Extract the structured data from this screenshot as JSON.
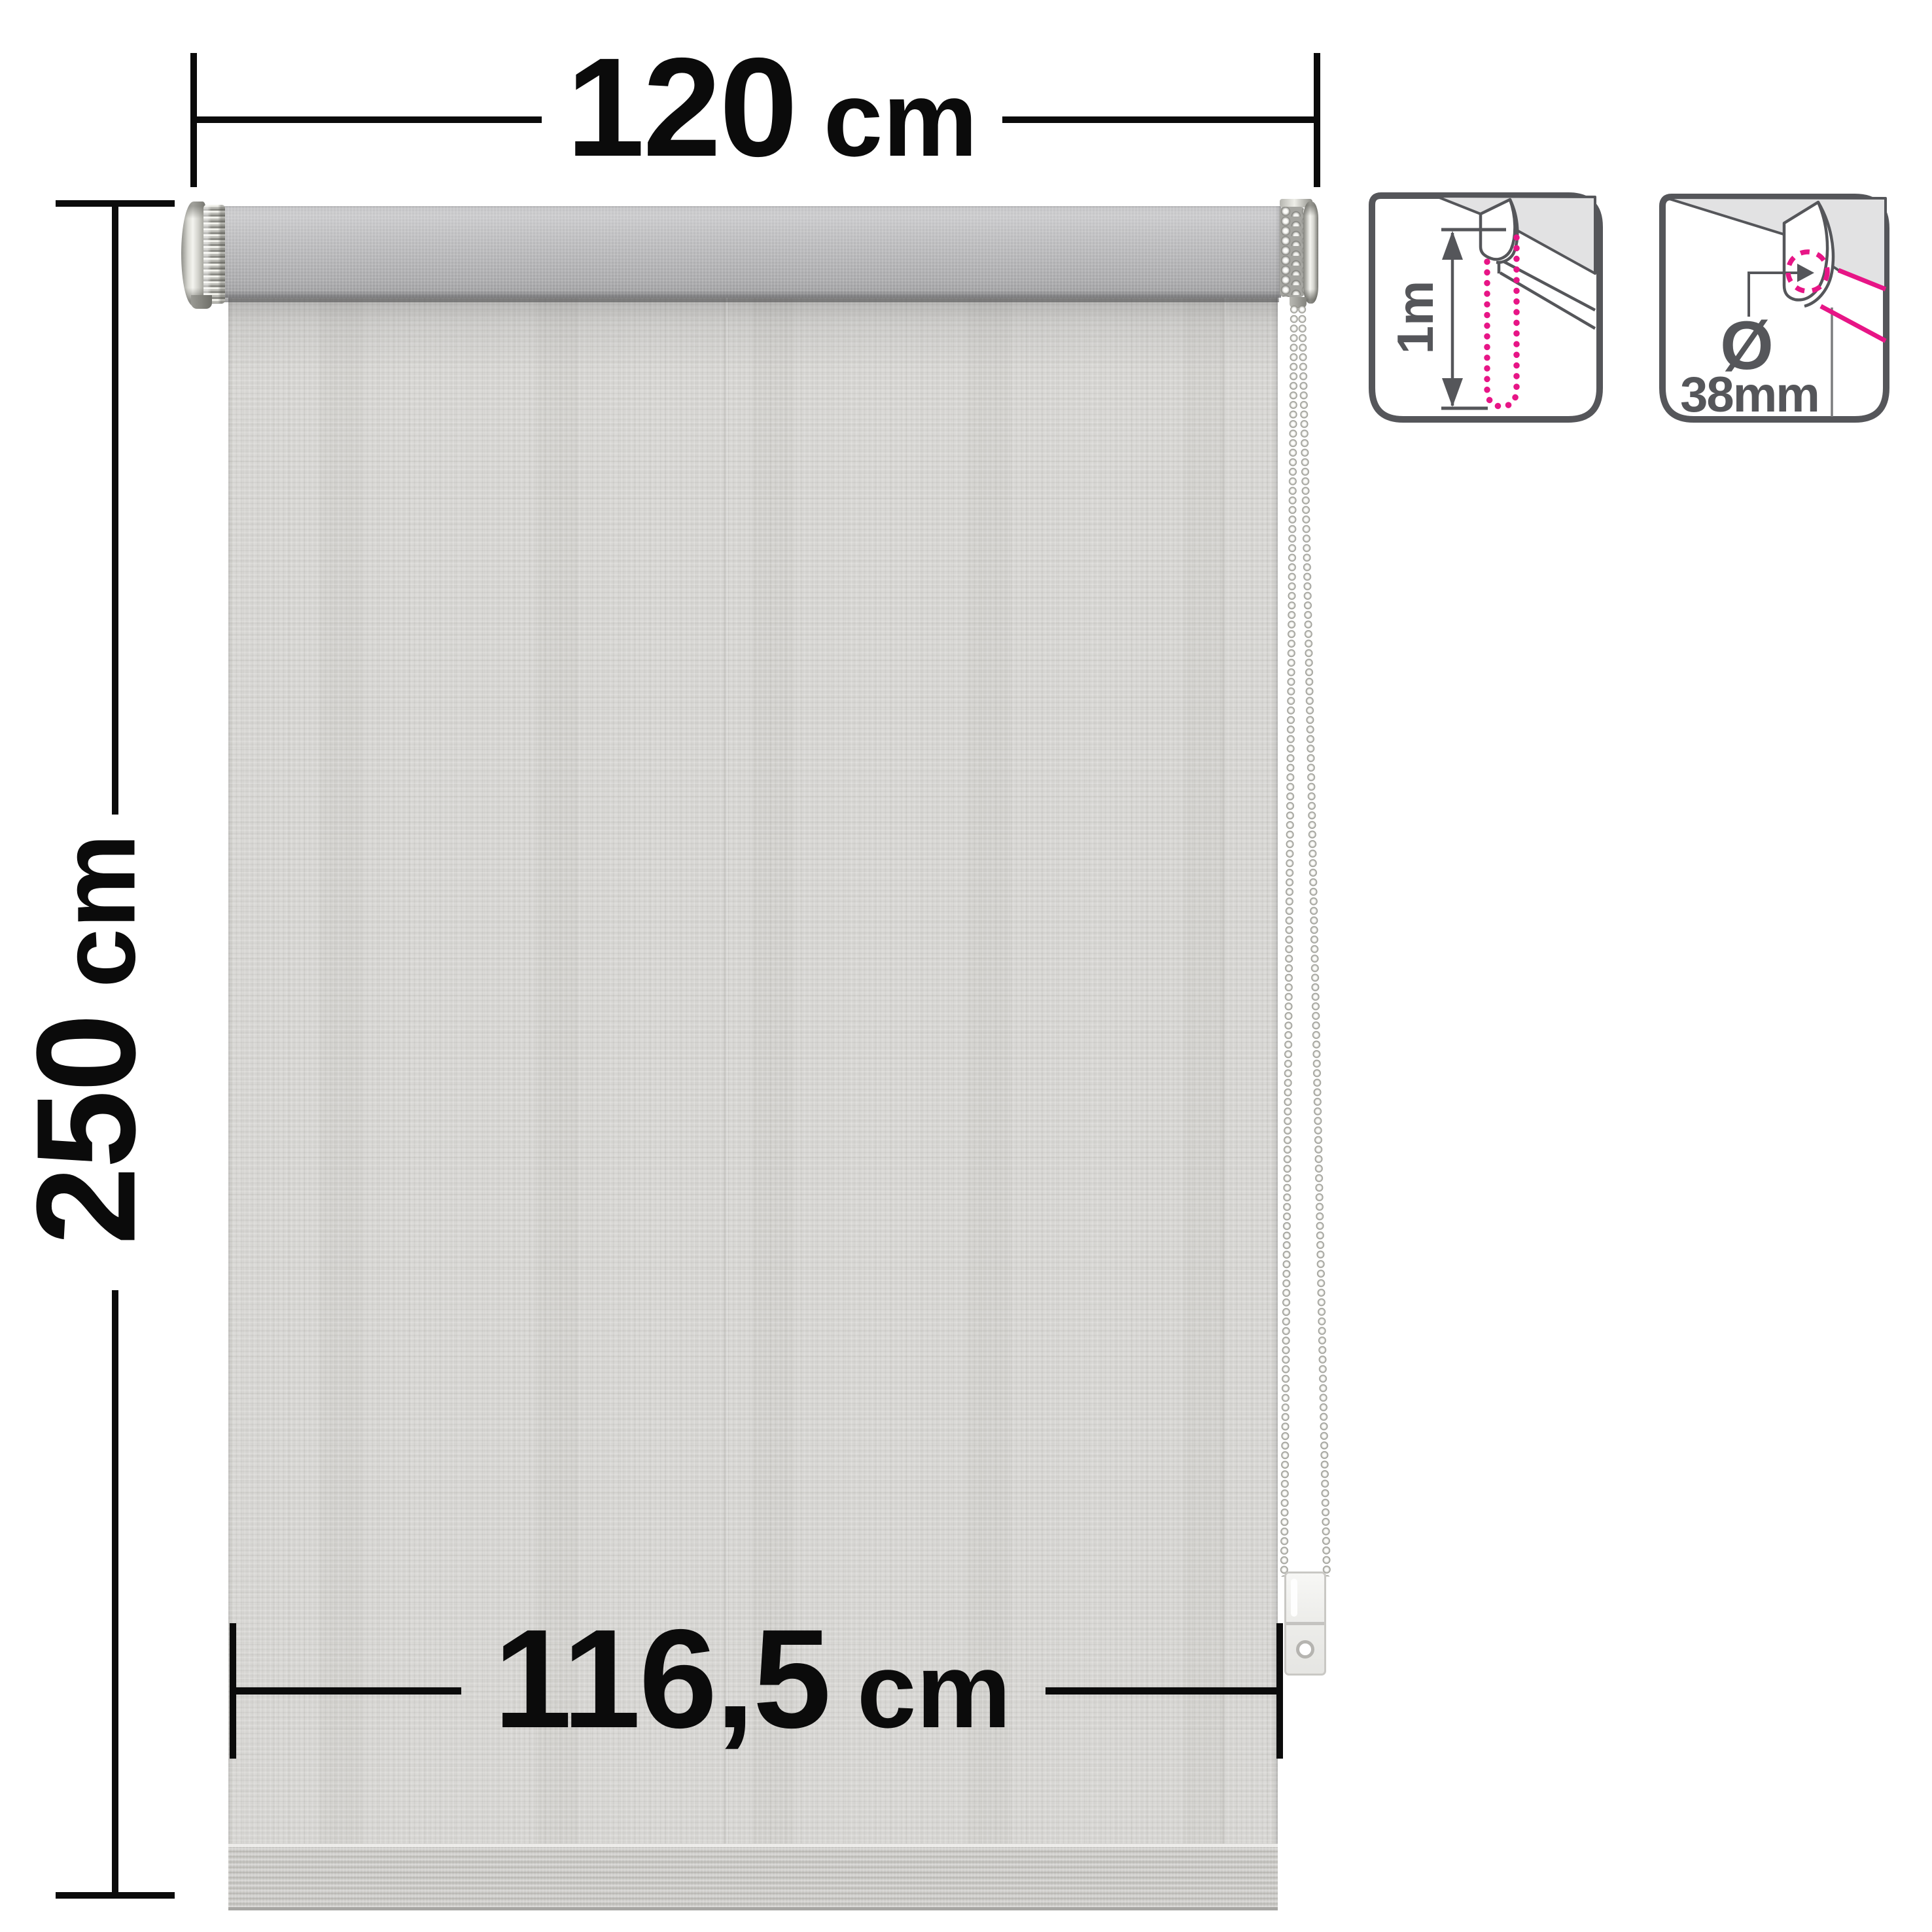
{
  "diagram": {
    "title": "Roller blind dimension diagram",
    "dimensions": {
      "width": {
        "value": "120",
        "unit": "cm"
      },
      "height": {
        "value": "250",
        "unit": "cm"
      },
      "fabric_width": {
        "value": "116,5",
        "unit": "cm"
      }
    },
    "icons": {
      "chain_length": {
        "label": "1m"
      },
      "tube_diameter": {
        "symbol": "Ø",
        "label": "38mm"
      }
    },
    "colors": {
      "dimension_black": "#0b0b0b",
      "icon_gray": "#55565a",
      "accent_pink": "#e71586",
      "ceiling_gray": "#e2e2e3",
      "fabric_gray": "#d8d7d4",
      "tube_gray": "#b5b5b7",
      "hem_gray": "#c9c8c5"
    }
  }
}
